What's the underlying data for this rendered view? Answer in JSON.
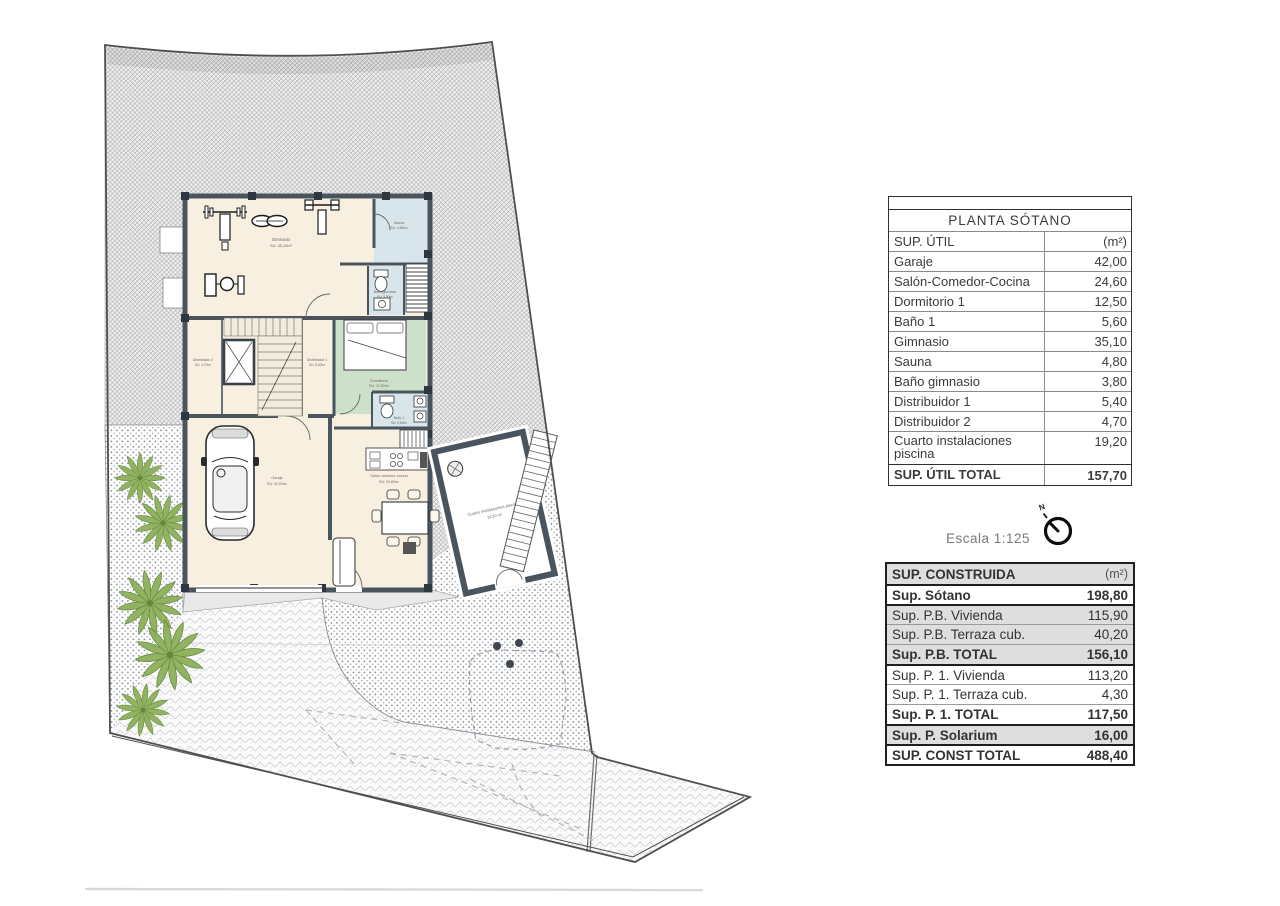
{
  "site": {
    "scale_label": "Escala 1:125",
    "north_label": "N"
  },
  "rooms": {
    "gimnasio": {
      "name": "Gimnasio",
      "area": "SU: 35,10m²"
    },
    "sauna": {
      "name": "Sauna",
      "area": "SU: 4,80m²"
    },
    "bano_gimnasio": {
      "name": "Baño gimnasio",
      "area": "SU: 3,80m²"
    },
    "distribuidor_2": {
      "name": "Distribuidor 2",
      "area": "SU: 4,70m²"
    },
    "distribuidor_1": {
      "name": "Distribuidor 1",
      "area": "SU: 5,40m²"
    },
    "dormitorio": {
      "name": "Dormitorio",
      "area": "SU: 12,50m²"
    },
    "bano_1": {
      "name": "Baño 1",
      "area": "SU: 5,60m²"
    },
    "garaje": {
      "name": "Garaje",
      "area": "SU: 42,00m²"
    },
    "salon": {
      "name": "Salón comedor cocina",
      "area": "SU: 24,60m²"
    },
    "instalaciones": {
      "name": "Cuarto instalaciones piscina",
      "area": "19,20 m²"
    }
  },
  "tables": {
    "sup_util": {
      "title": "PLANTA SÓTANO",
      "col_label": "SUP. ÚTIL",
      "col_unit": "(m²)",
      "rows": [
        {
          "label": "Garaje",
          "value": "42,00"
        },
        {
          "label": "Salón-Comedor-Cocina",
          "value": "24,60"
        },
        {
          "label": "Dormitorio 1",
          "value": "12,50"
        },
        {
          "label": "Baño 1",
          "value": "5,60"
        },
        {
          "label": "Gimnasio",
          "value": "35,10"
        },
        {
          "label": "Sauna",
          "value": "4,80"
        },
        {
          "label": "Baño gimnasio",
          "value": "3,80"
        },
        {
          "label": "Distribuidor 1",
          "value": "5,40"
        },
        {
          "label": "Distribuidor 2",
          "value": "4,70"
        },
        {
          "label": "Cuarto instalaciones piscina",
          "value": "19,20"
        }
      ],
      "total_label": "SUP. ÚTIL TOTAL",
      "total_value": "157,70"
    },
    "sup_construida": {
      "header_label": "SUP. CONSTRUIDA",
      "header_unit": "(m²)",
      "rows": [
        {
          "label": "Sup. Sótano",
          "value": "198,80"
        },
        {
          "label": "Sup. P.B. Vivienda",
          "value": "115,90"
        },
        {
          "label": "Sup. P.B. Terraza cub.",
          "value": "40,20"
        },
        {
          "label": "Sup. P.B. TOTAL",
          "value": "156,10"
        },
        {
          "label": "Sup. P. 1. Vivienda",
          "value": "113,20"
        },
        {
          "label": "Sup. P. 1. Terraza cub.",
          "value": "4,30"
        },
        {
          "label": "Sup. P. 1. TOTAL",
          "value": "117,50"
        },
        {
          "label": "Sup. P. Solarium",
          "value": "16,00"
        },
        {
          "label": "SUP. CONST TOTAL",
          "value": "488,40"
        }
      ]
    }
  },
  "colors": {
    "wall": "#4a545e",
    "floor_cream": "#f7efdf",
    "bedroom_green": "#cde0ca",
    "bath_blue": "#d8e6ec",
    "palm_green": "#8db05a",
    "terrain_hatch": "#a8a8a8",
    "table_row_gray": "#dedede",
    "text_dark": "#3b3b3b"
  }
}
